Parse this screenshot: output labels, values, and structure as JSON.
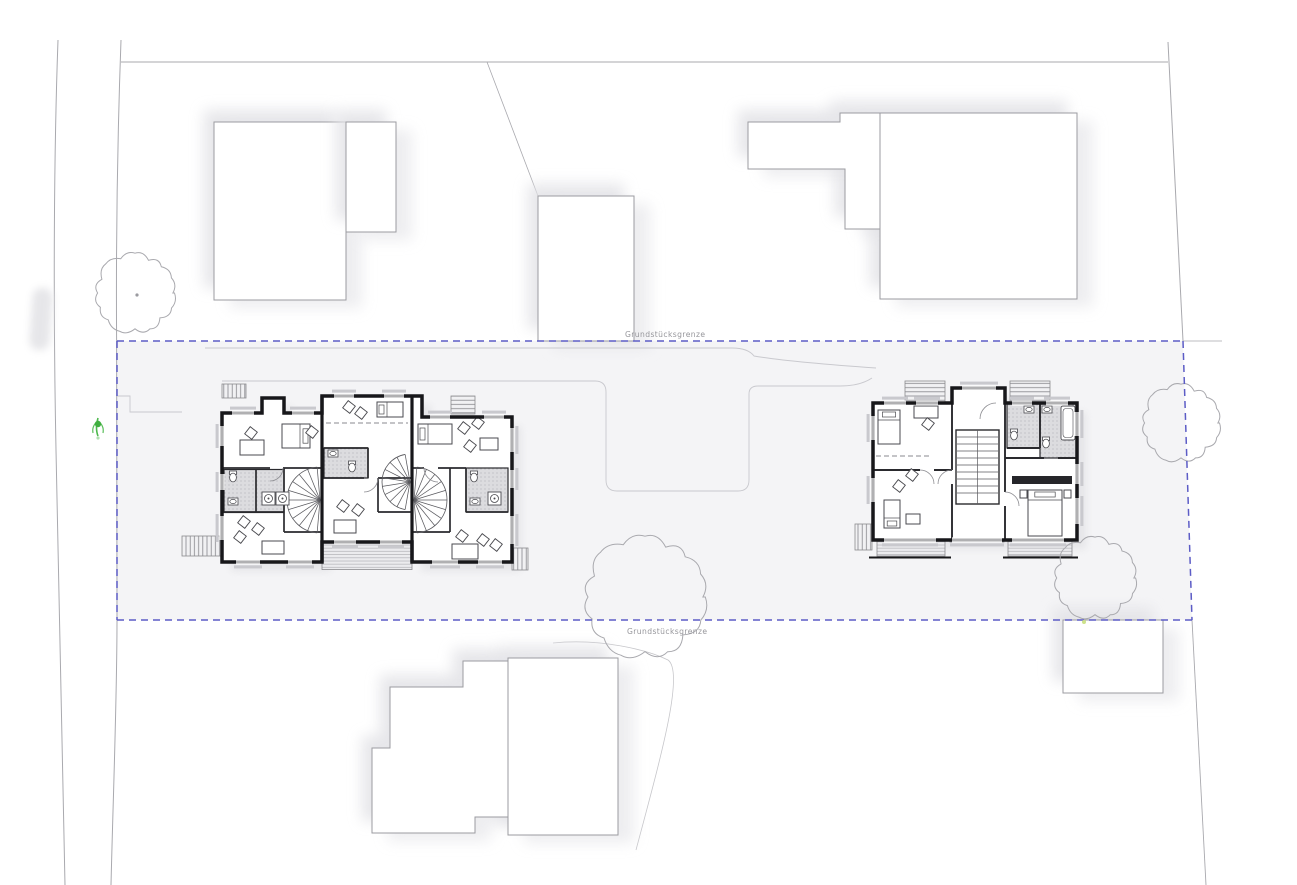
{
  "labels": {
    "boundary_top": "Grundstücksgrenze",
    "boundary_bottom": "Grundstücksgrenze"
  },
  "colors": {
    "boundary_dash": "#5c5cc6",
    "parcel_fill": "#f4f4f6",
    "wall": "#17171a",
    "site_line": "#a9a9ae",
    "path_line": "#c9c9ce",
    "label_text": "#96969b",
    "plant_green": "#3fae3f",
    "bath_floor": "#dcdcdf",
    "shadow": "#e2e2e6",
    "window_sill": "#c9c9ce"
  },
  "icons": {
    "tree_symbol": "tree-canopy-icon",
    "plant_symbol": "plant-icon"
  }
}
